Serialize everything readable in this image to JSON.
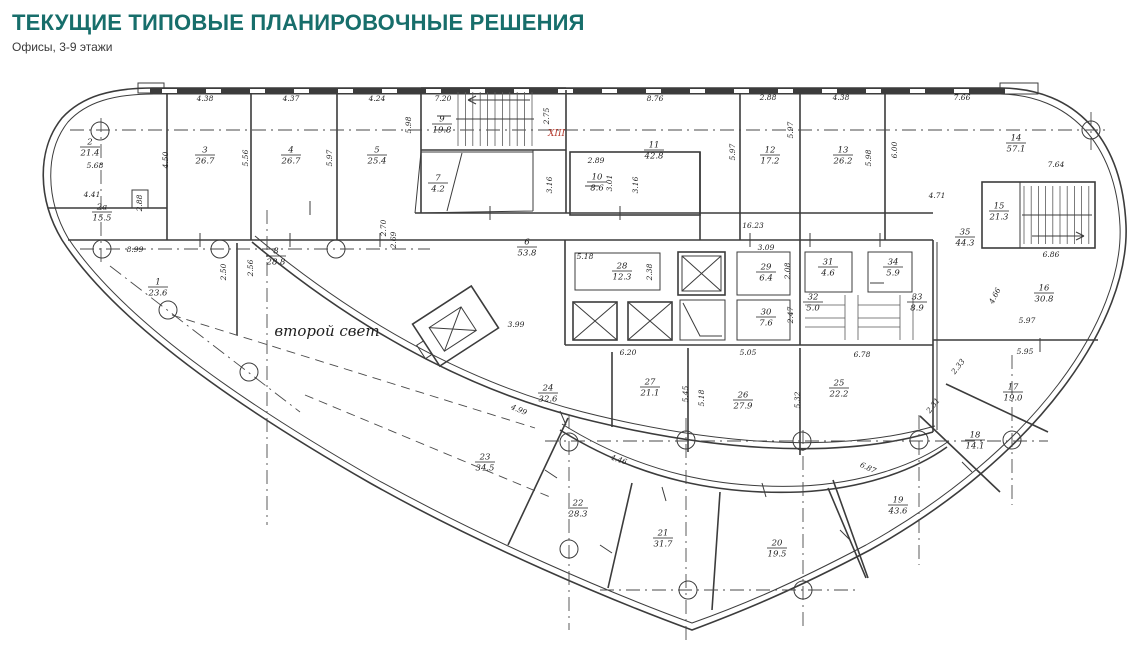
{
  "header": {
    "title": "ТЕКУЩИЕ ТИПОВЫЕ ПЛАНИРОВОЧНЫЕ РЕШЕНИЯ",
    "subtitle": "Офисы, 3-9 этажи",
    "title_color": "#176e6b"
  },
  "plan": {
    "second_light_label": "второй свет",
    "stair_mark": "XIII",
    "stair_mark_color": "#b53a2e",
    "line_color": "#3c3c3c",
    "rooms": [
      {
        "num": "1",
        "area": "23.6",
        "x": 158,
        "y": 287
      },
      {
        "num": "2",
        "area": "21.4",
        "x": 90,
        "y": 147
      },
      {
        "num": "2а",
        "area": "15.5",
        "x": 102,
        "y": 212
      },
      {
        "num": "3",
        "area": "26.7",
        "x": 205,
        "y": 155
      },
      {
        "num": "4",
        "area": "26.7",
        "x": 291,
        "y": 155
      },
      {
        "num": "5",
        "area": "25.4",
        "x": 377,
        "y": 155
      },
      {
        "num": "6",
        "area": "53.8",
        "x": 527,
        "y": 247
      },
      {
        "num": "7",
        "area": "4.2",
        "x": 438,
        "y": 183
      },
      {
        "num": "8",
        "area": "28.8",
        "x": 276,
        "y": 256
      },
      {
        "num": "9",
        "area": "19.8",
        "x": 442,
        "y": 124
      },
      {
        "num": "10",
        "area": "8.6",
        "x": 597,
        "y": 182
      },
      {
        "num": "11",
        "area": "42.8",
        "x": 654,
        "y": 150
      },
      {
        "num": "12",
        "area": "17.2",
        "x": 770,
        "y": 155
      },
      {
        "num": "13",
        "area": "26.2",
        "x": 843,
        "y": 155
      },
      {
        "num": "14",
        "area": "57.1",
        "x": 1016,
        "y": 143
      },
      {
        "num": "15",
        "area": "21.3",
        "x": 999,
        "y": 211
      },
      {
        "num": "16",
        "area": "30.8",
        "x": 1044,
        "y": 293
      },
      {
        "num": "17",
        "area": "19.0",
        "x": 1013,
        "y": 392
      },
      {
        "num": "18",
        "area": "14.1",
        "x": 975,
        "y": 440
      },
      {
        "num": "19",
        "area": "43.6",
        "x": 898,
        "y": 505
      },
      {
        "num": "20",
        "area": "19.5",
        "x": 777,
        "y": 548
      },
      {
        "num": "21",
        "area": "31.7",
        "x": 663,
        "y": 538
      },
      {
        "num": "22",
        "area": "28.3",
        "x": 578,
        "y": 508
      },
      {
        "num": "23",
        "area": "34.5",
        "x": 485,
        "y": 462
      },
      {
        "num": "24",
        "area": "32.6",
        "x": 548,
        "y": 393
      },
      {
        "num": "25",
        "area": "22.2",
        "x": 839,
        "y": 388
      },
      {
        "num": "26",
        "area": "27.9",
        "x": 743,
        "y": 400
      },
      {
        "num": "27",
        "area": "21.1",
        "x": 650,
        "y": 387
      },
      {
        "num": "28",
        "area": "12.3",
        "x": 622,
        "y": 271
      },
      {
        "num": "29",
        "area": "6.4",
        "x": 766,
        "y": 272
      },
      {
        "num": "30",
        "area": "7.6",
        "x": 766,
        "y": 317
      },
      {
        "num": "31",
        "area": "4.6",
        "x": 828,
        "y": 267
      },
      {
        "num": "32",
        "area": "5.0",
        "x": 813,
        "y": 302
      },
      {
        "num": "33",
        "area": "8.9",
        "x": 917,
        "y": 302
      },
      {
        "num": "34",
        "area": "5.9",
        "x": 893,
        "y": 267
      },
      {
        "num": "35",
        "area": "44.3",
        "x": 965,
        "y": 237
      }
    ],
    "dimensions": [
      {
        "t": "4.38",
        "x": 205,
        "y": 101
      },
      {
        "t": "4.37",
        "x": 291,
        "y": 101
      },
      {
        "t": "4.24",
        "x": 377,
        "y": 101
      },
      {
        "t": "7.20",
        "x": 443,
        "y": 101
      },
      {
        "t": "8.76",
        "x": 655,
        "y": 101
      },
      {
        "t": "2.88",
        "x": 768,
        "y": 100
      },
      {
        "t": "4.38",
        "x": 841,
        "y": 100
      },
      {
        "t": "7.66",
        "x": 962,
        "y": 100
      },
      {
        "t": "4.50",
        "x": 168,
        "y": 160,
        "r": -90
      },
      {
        "t": "5.56",
        "x": 248,
        "y": 158,
        "r": -90
      },
      {
        "t": "5.97",
        "x": 332,
        "y": 158,
        "r": -90
      },
      {
        "t": "5.98",
        "x": 411,
        "y": 125,
        "r": -90
      },
      {
        "t": "2.75",
        "x": 549,
        "y": 116,
        "r": -90
      },
      {
        "t": "3.16",
        "x": 552,
        "y": 185,
        "r": -90
      },
      {
        "t": "2.89",
        "x": 596,
        "y": 163
      },
      {
        "t": "3.01",
        "x": 612,
        "y": 183,
        "r": -90
      },
      {
        "t": "3.16",
        "x": 638,
        "y": 185,
        "r": -90
      },
      {
        "t": "5.97",
        "x": 735,
        "y": 152,
        "r": -90
      },
      {
        "t": "5.97",
        "x": 793,
        "y": 130,
        "r": -90
      },
      {
        "t": "5.98",
        "x": 871,
        "y": 158,
        "r": -90
      },
      {
        "t": "6.00",
        "x": 897,
        "y": 150,
        "r": -90
      },
      {
        "t": "4.71",
        "x": 937,
        "y": 198
      },
      {
        "t": "7.64",
        "x": 1056,
        "y": 167
      },
      {
        "t": "16.23",
        "x": 753,
        "y": 228
      },
      {
        "t": "5.68",
        "x": 95,
        "y": 168
      },
      {
        "t": "4.41",
        "x": 92,
        "y": 197
      },
      {
        "t": "2.88",
        "x": 142,
        "y": 203,
        "r": -90
      },
      {
        "t": "8.99",
        "x": 135,
        "y": 252
      },
      {
        "t": "2.50",
        "x": 226,
        "y": 272,
        "r": -90
      },
      {
        "t": "2.56",
        "x": 253,
        "y": 268,
        "r": -90
      },
      {
        "t": "2.70",
        "x": 386,
        "y": 228,
        "r": -90
      },
      {
        "t": "2.69",
        "x": 396,
        "y": 240,
        "r": -90
      },
      {
        "t": "5.18",
        "x": 585,
        "y": 259
      },
      {
        "t": "2.38",
        "x": 652,
        "y": 272,
        "r": -90
      },
      {
        "t": "3.09",
        "x": 766,
        "y": 250
      },
      {
        "t": "2.08",
        "x": 790,
        "y": 271,
        "r": -90
      },
      {
        "t": "2.47",
        "x": 793,
        "y": 315,
        "r": -90
      },
      {
        "t": "6.20",
        "x": 628,
        "y": 355
      },
      {
        "t": "5.05",
        "x": 748,
        "y": 355
      },
      {
        "t": "6.78",
        "x": 862,
        "y": 357
      },
      {
        "t": "6.86",
        "x": 1051,
        "y": 257
      },
      {
        "t": "4.66",
        "x": 997,
        "y": 297,
        "r": -63
      },
      {
        "t": "5.97",
        "x": 1027,
        "y": 323
      },
      {
        "t": "5.95",
        "x": 1025,
        "y": 354
      },
      {
        "t": "3.99",
        "x": 516,
        "y": 327
      },
      {
        "t": "4.99",
        "x": 518,
        "y": 412,
        "r": 23
      },
      {
        "t": "4.46",
        "x": 618,
        "y": 462,
        "r": 18
      },
      {
        "t": "5.45",
        "x": 688,
        "y": 394,
        "r": -90
      },
      {
        "t": "5.18",
        "x": 704,
        "y": 398,
        "r": -90
      },
      {
        "t": "5.32",
        "x": 800,
        "y": 400,
        "r": -90
      },
      {
        "t": "2.33",
        "x": 960,
        "y": 368,
        "r": -52
      },
      {
        "t": "2.31",
        "x": 935,
        "y": 407,
        "r": -52
      },
      {
        "t": "6.87",
        "x": 867,
        "y": 470,
        "r": 25
      }
    ],
    "grid_circles": [
      [
        100,
        131
      ],
      [
        1091,
        130
      ],
      [
        102,
        249
      ],
      [
        220,
        249
      ],
      [
        336,
        249
      ],
      [
        168,
        310
      ],
      [
        249,
        372
      ],
      [
        569,
        442
      ],
      [
        686,
        440
      ],
      [
        802,
        441
      ],
      [
        919,
        440
      ],
      [
        1012,
        440
      ],
      [
        569,
        549
      ],
      [
        688,
        590
      ],
      [
        803,
        590
      ]
    ]
  }
}
